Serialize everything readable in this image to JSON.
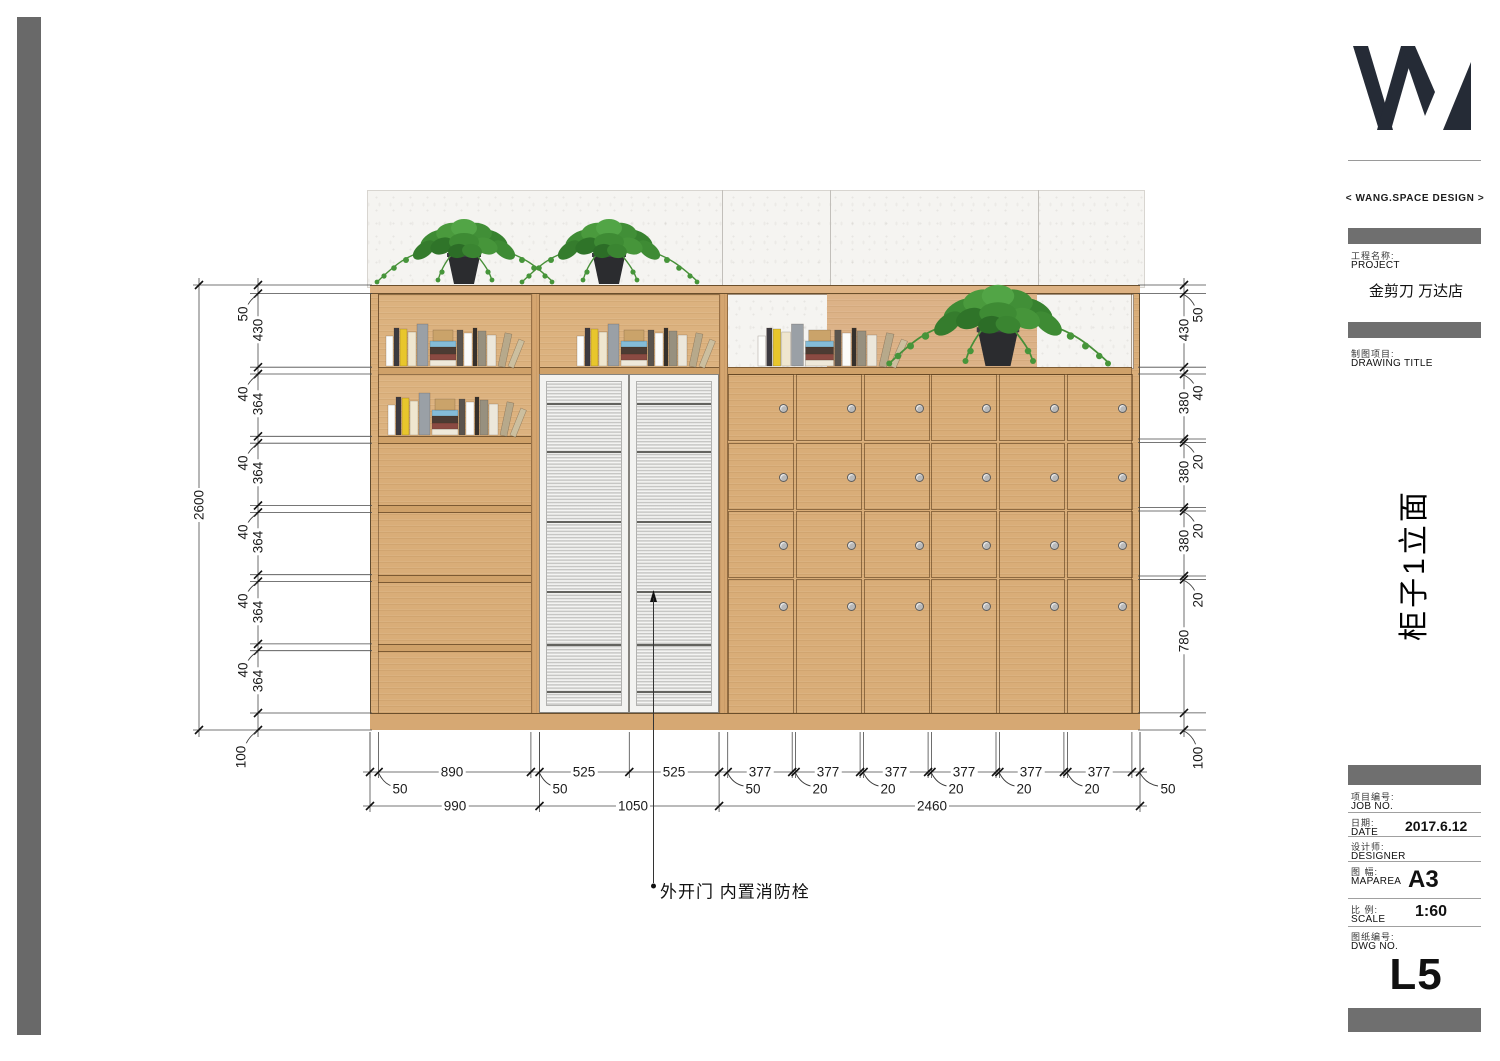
{
  "brand": {
    "name": "< WANG.SPACE DESIGN >"
  },
  "title_block": {
    "project_zh": "工程名称:",
    "project_en": "PROJECT",
    "project_value": "金剪刀 万达店",
    "drawing_zh": "制图项目:",
    "drawing_en": "DRAWING TITLE",
    "drawing_value": "柜子1立面",
    "job_zh": "项目编号:",
    "job_en": "JOB NO.",
    "date_zh": "日期:",
    "date_en": "DATE",
    "date_value": "2017.6.12",
    "designer_zh": "设计师:",
    "designer_en": "DESIGNER",
    "maparea_zh": "图 幅:",
    "maparea_en": "MAPAREA",
    "maparea_value": "A3",
    "scale_zh": "比 例:",
    "scale_en": "SCALE",
    "scale_value": "1:60",
    "dwg_zh": "图纸编号:",
    "dwg_en": "DWG NO.",
    "dwg_value": "L5"
  },
  "drawing": {
    "annotation": "外开门 内置消防栓",
    "dims": {
      "overall": "2600",
      "l": [
        "50",
        "430",
        "40",
        "364",
        "40",
        "364",
        "40",
        "364",
        "40",
        "364",
        "40",
        "364",
        "100"
      ],
      "r": [
        "50",
        "430",
        "40",
        "380",
        "20",
        "380",
        "20",
        "380",
        "20",
        "780",
        "100"
      ],
      "b1": [
        "50",
        "890",
        "50",
        "525",
        "525",
        "50",
        "377",
        "20",
        "377",
        "20",
        "377",
        "20",
        "377",
        "20",
        "377",
        "20",
        "377",
        "50"
      ],
      "b2": [
        "990",
        "1050",
        "2460"
      ]
    }
  }
}
